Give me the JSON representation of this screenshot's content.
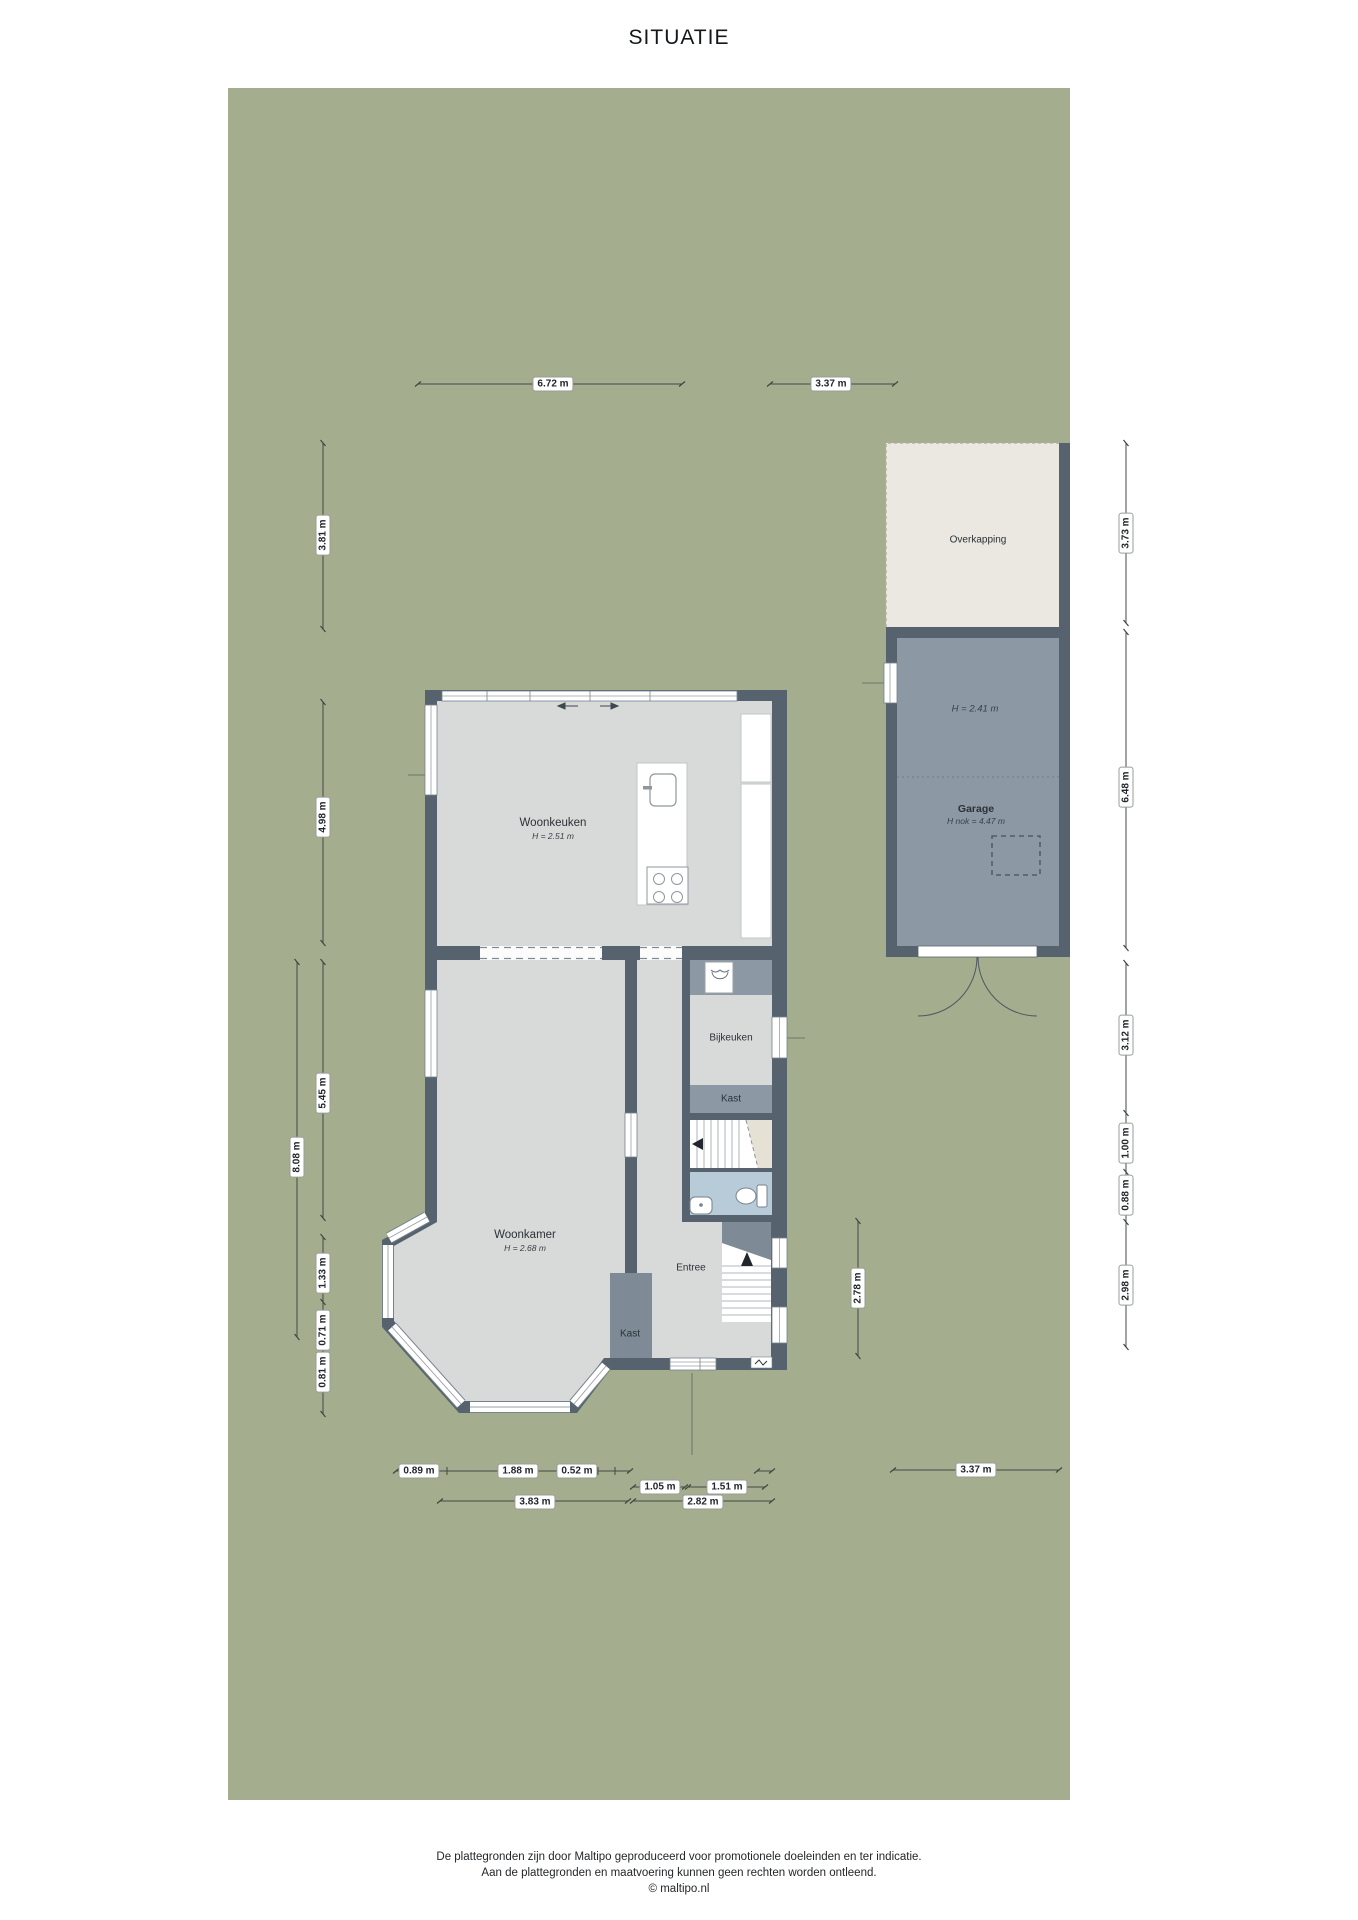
{
  "title": "SITUATIE",
  "rooms": {
    "woonkeuken": {
      "name": "Woonkeuken",
      "height": "H = 2.51 m"
    },
    "woonkamer": {
      "name": "Woonkamer",
      "height": "H = 2.68 m"
    },
    "bijkeuken": {
      "name": "Bijkeuken"
    },
    "kast_boven": {
      "name": "Kast"
    },
    "kast_entree": {
      "name": "Kast"
    },
    "entree": {
      "name": "Entree"
    },
    "garage": {
      "name": "Garage",
      "height": "H = 2.41 m",
      "nok_height": "H nok = 4.47 m"
    },
    "overkapping": {
      "name": "Overkapping"
    }
  },
  "dimensions": {
    "top": [
      {
        "label": "6.72 m"
      },
      {
        "label": "3.37 m"
      }
    ],
    "left": [
      {
        "label": "3.81 m"
      },
      {
        "label": "4.98 m"
      },
      {
        "label": "5.45 m"
      },
      {
        "label": "8.08 m"
      },
      {
        "label": "1.33 m"
      },
      {
        "label": "0.71 m"
      },
      {
        "label": "0.81 m"
      }
    ],
    "right": [
      {
        "label": "3.73 m"
      },
      {
        "label": "6.48 m"
      },
      {
        "label": "3.12 m"
      },
      {
        "label": "1.00 m"
      },
      {
        "label": "0.88 m"
      },
      {
        "label": "2.98 m"
      }
    ],
    "middle": [
      {
        "label": "2.78 m"
      }
    ],
    "bottom_row1": [
      {
        "label": "0.89 m"
      },
      {
        "label": "1.88 m"
      },
      {
        "label": "0.52 m"
      }
    ],
    "bottom_row2": [
      {
        "label": "1.05 m"
      },
      {
        "label": "1.51 m"
      }
    ],
    "bottom_row3": [
      {
        "label": "3.83 m"
      },
      {
        "label": "2.82 m"
      }
    ],
    "bottom_right": [
      {
        "label": "3.37 m"
      }
    ]
  },
  "footer": {
    "line1": "De plattegronden zijn door Maltipo geproduceerd voor promotionele doeleinden en ter indicatie.",
    "line2": "Aan de plattegronden en maatvoering kunnen geen rechten worden ontleend.",
    "line3": "© maltipo.nl"
  },
  "colors": {
    "garden_green": "#a4ae8e",
    "wall_dark": "#56636e",
    "floor_gray": "#d8dada",
    "garage_floor": "#8c99a5",
    "overkapping_cream": "#eae8e0",
    "toilet_blue": "#b7ccd8",
    "stair_void_beige": "#e6e1d5"
  }
}
